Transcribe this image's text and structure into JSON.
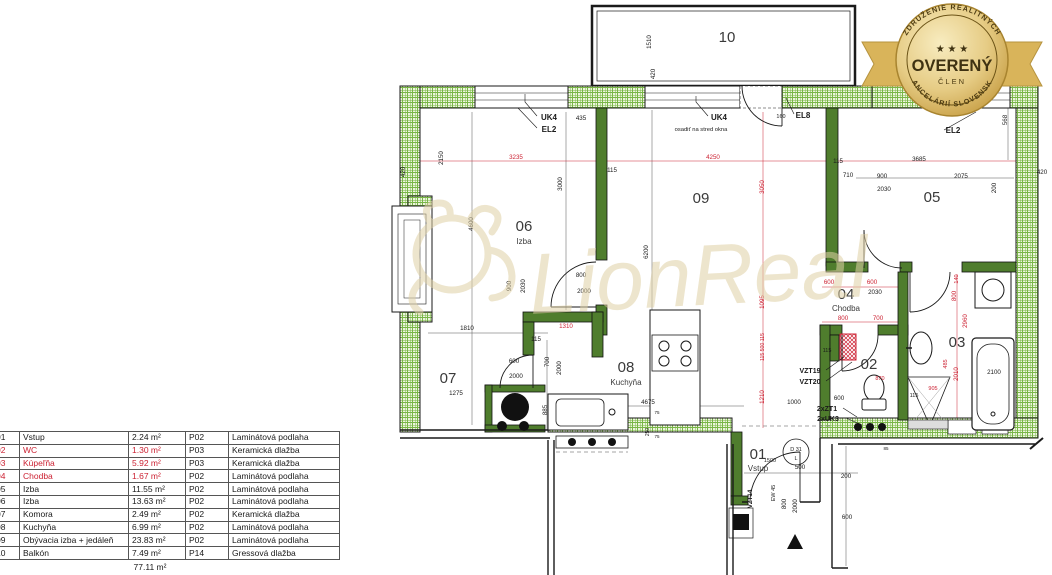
{
  "colors": {
    "dim_black": "#1a1a1a",
    "dim_red": "#cc2233",
    "wall_green": "#4f7d2d",
    "hatch_green": "#79b647",
    "badge_gold": "#d9b45a",
    "watermark_beige": "#e0d1a6"
  },
  "badge": {
    "arc_top": "ZDRUŽENIE REALITNÝCH",
    "arc_bottom": "KANCELÁRIÍ SLOVENSKA",
    "stars": "★ ★ ★",
    "title": "OVERENÝ",
    "subtitle": "ČLEN"
  },
  "watermark": {
    "text": "LionReal"
  },
  "legend_table": {
    "rows": [
      {
        "num": "01",
        "name": "Vstup",
        "area": "2.24 m²",
        "code": "P02",
        "floor": "Laminátová podlaha",
        "red": false
      },
      {
        "num": "02",
        "name": "WC",
        "area": "1.30 m²",
        "code": "P03",
        "floor": "Keramická dlažba",
        "red": true
      },
      {
        "num": "03",
        "name": "Kúpeľňa",
        "area": "5.92 m²",
        "code": "P03",
        "floor": "Keramická dlažba",
        "red": true
      },
      {
        "num": "04",
        "name": "Chodba",
        "area": "1.67 m²",
        "code": "P02",
        "floor": "Laminátová podlaha",
        "red": true
      },
      {
        "num": "05",
        "name": "Izba",
        "area": "11.55 m²",
        "code": "P02",
        "floor": "Laminátová podlaha",
        "red": false
      },
      {
        "num": "06",
        "name": "Izba",
        "area": "13.63 m²",
        "code": "P02",
        "floor": "Laminátová podlaha",
        "red": false
      },
      {
        "num": "07",
        "name": "Komora",
        "area": "2.49 m²",
        "code": "P02",
        "floor": "Keramická dlažba",
        "red": false
      },
      {
        "num": "08",
        "name": "Kuchyňa",
        "area": "6.99 m²",
        "code": "P02",
        "floor": "Laminátová podlaha",
        "red": false
      },
      {
        "num": "09",
        "name": "Obývacia izba + jedáleň",
        "area": "23.83 m²",
        "code": "P02",
        "floor": "Laminátová podlaha",
        "red": false
      },
      {
        "num": "10",
        "name": "Balkón",
        "area": "7.49 m²",
        "code": "P14",
        "floor": "Gressová dlažba",
        "red": false
      }
    ],
    "total": "77.11 m²"
  },
  "floorplan": {
    "rooms": [
      {
        "num": "10",
        "x": 727,
        "y": 42
      },
      {
        "num": "06",
        "name": "Izba",
        "x": 524,
        "y": 231,
        "ny": 244
      },
      {
        "num": "09",
        "x": 701,
        "y": 203
      },
      {
        "num": "05",
        "x": 932,
        "y": 202
      },
      {
        "num": "07",
        "x": 448,
        "y": 383
      },
      {
        "num": "08",
        "name": "Kuchyňa",
        "x": 626,
        "y": 372,
        "ny": 385
      },
      {
        "num": "04",
        "name": "Chodba",
        "x": 846,
        "y": 299,
        "ny": 311
      },
      {
        "num": "02",
        "x": 869,
        "y": 369
      },
      {
        "num": "03",
        "x": 957,
        "y": 347
      },
      {
        "num": "01",
        "name": "Vstup",
        "x": 758,
        "y": 459,
        "ny": 471
      }
    ],
    "texts": [
      {
        "t": "1510",
        "x": 651,
        "y": 42,
        "v": 1
      },
      {
        "t": "420",
        "x": 655,
        "y": 74,
        "v": 1
      },
      {
        "t": "420",
        "x": 405,
        "y": 172,
        "v": 1
      },
      {
        "t": "2150",
        "x": 443,
        "y": 158,
        "v": 1
      },
      {
        "t": "4600",
        "x": 473,
        "y": 224,
        "v": 1
      },
      {
        "t": "3000",
        "x": 562,
        "y": 184,
        "v": 1
      },
      {
        "t": "6200",
        "x": 648,
        "y": 252,
        "v": 1
      },
      {
        "t": "435",
        "x": 581,
        "y": 120
      },
      {
        "t": "115",
        "x": 612,
        "y": 172
      },
      {
        "t": "115",
        "x": 838,
        "y": 163
      },
      {
        "t": "710",
        "x": 848,
        "y": 177
      },
      {
        "t": "900",
        "x": 882,
        "y": 178
      },
      {
        "t": "2030",
        "x": 884,
        "y": 191
      },
      {
        "t": "2075",
        "x": 961,
        "y": 178
      },
      {
        "t": "3685",
        "x": 919,
        "y": 161
      },
      {
        "t": "200",
        "x": 996,
        "y": 188,
        "v": 1
      },
      {
        "t": "568",
        "x": 1007,
        "y": 120,
        "v": 1
      },
      {
        "t": "420",
        "x": 1042,
        "y": 174
      },
      {
        "t": "900",
        "x": 511,
        "y": 286,
        "v": 1
      },
      {
        "t": "2030",
        "x": 525,
        "y": 286,
        "v": 1
      },
      {
        "t": "800",
        "x": 581,
        "y": 277
      },
      {
        "t": "2000",
        "x": 584,
        "y": 293
      },
      {
        "t": "1810",
        "x": 467,
        "y": 330
      },
      {
        "t": "1275",
        "x": 456,
        "y": 395
      },
      {
        "t": "115",
        "x": 536,
        "y": 341
      },
      {
        "t": "700",
        "x": 549,
        "y": 362,
        "v": 1
      },
      {
        "t": "2000",
        "x": 561,
        "y": 368,
        "v": 1
      },
      {
        "t": "600",
        "x": 514,
        "y": 363
      },
      {
        "t": "2000",
        "x": 516,
        "y": 378
      },
      {
        "t": "885",
        "x": 547,
        "y": 410,
        "v": 1
      },
      {
        "t": "4675",
        "x": 648,
        "y": 404
      },
      {
        "t": "1000",
        "x": 794,
        "y": 404
      },
      {
        "t": "600",
        "x": 839,
        "y": 400
      },
      {
        "t": "250",
        "x": 649,
        "y": 432,
        "v": 1,
        "s": 5
      },
      {
        "t": "75",
        "x": 657,
        "y": 414,
        "s": 4.5
      },
      {
        "t": "75",
        "x": 657,
        "y": 438,
        "s": 4.5
      },
      {
        "t": "85",
        "x": 886,
        "y": 450,
        "s": 4.5
      },
      {
        "t": "115",
        "x": 914,
        "y": 397,
        "s": 5.5
      },
      {
        "t": "1500",
        "x": 770,
        "y": 462,
        "s": 5.5
      },
      {
        "t": "500",
        "x": 800,
        "y": 469
      },
      {
        "t": "200",
        "x": 846,
        "y": 478
      },
      {
        "t": "600",
        "x": 847,
        "y": 519
      },
      {
        "t": "800",
        "x": 786,
        "y": 504,
        "v": 1
      },
      {
        "t": "2000",
        "x": 797,
        "y": 506,
        "v": 1
      },
      {
        "t": "EW 45",
        "x": 775,
        "y": 493,
        "v": 1,
        "s": 5.5
      },
      {
        "t": "VZT14",
        "x": 752,
        "y": 499,
        "v": 1,
        "b": 1
      },
      {
        "t": "160",
        "x": 781,
        "y": 118,
        "s": 5.5
      },
      {
        "t": "2100",
        "x": 994,
        "y": 374
      },
      {
        "t": "3235",
        "x": 516,
        "y": 159,
        "c": "r"
      },
      {
        "t": "4250",
        "x": 713,
        "y": 159,
        "c": "r"
      },
      {
        "t": "3050",
        "x": 764,
        "y": 187,
        "v": 1,
        "c": "r"
      },
      {
        "t": "1095",
        "x": 764,
        "y": 302,
        "v": 1,
        "c": "r"
      },
      {
        "t": "115 500 115",
        "x": 764,
        "y": 347,
        "v": 1,
        "c": "r",
        "s": 5.2
      },
      {
        "t": "1210",
        "x": 764,
        "y": 397,
        "v": 1,
        "c": "r"
      },
      {
        "t": "1310",
        "x": 566,
        "y": 328,
        "c": "r"
      },
      {
        "t": "600",
        "x": 829,
        "y": 284,
        "c": "r"
      },
      {
        "t": "600",
        "x": 872,
        "y": 284,
        "c": "r"
      },
      {
        "t": "2030",
        "x": 875,
        "y": 294
      },
      {
        "t": "800",
        "x": 843,
        "y": 320,
        "c": "r"
      },
      {
        "t": "700",
        "x": 878,
        "y": 320,
        "c": "r"
      },
      {
        "t": "115",
        "x": 827,
        "y": 352,
        "s": 5.5
      },
      {
        "t": "870",
        "x": 880,
        "y": 380,
        "c": "r",
        "s": 5.5
      },
      {
        "t": "905",
        "x": 933,
        "y": 390,
        "c": "r",
        "s": 5.5
      },
      {
        "t": "140",
        "x": 958,
        "y": 279,
        "v": 1,
        "c": "r",
        "s": 5.5
      },
      {
        "t": "800",
        "x": 956,
        "y": 296,
        "v": 1,
        "c": "r"
      },
      {
        "t": "2960",
        "x": 967,
        "y": 321,
        "v": 1,
        "c": "r"
      },
      {
        "t": "485",
        "x": 947,
        "y": 364,
        "v": 1,
        "c": "r",
        "s": 5.5
      },
      {
        "t": "2010",
        "x": 958,
        "y": 374,
        "v": 1,
        "c": "r"
      },
      {
        "t": "VZT19",
        "x": 810,
        "y": 373,
        "b": 1,
        "s": 7
      },
      {
        "t": "VZT20",
        "x": 810,
        "y": 384,
        "b": 1,
        "s": 7
      },
      {
        "t": "2xZT1",
        "x": 827,
        "y": 411,
        "b": 1,
        "s": 7
      },
      {
        "t": "2xUK3",
        "x": 828,
        "y": 421,
        "b": 1,
        "s": 7
      },
      {
        "t": "UK4",
        "x": 549,
        "y": 120,
        "b": 1,
        "s": 8
      },
      {
        "t": "EL2",
        "x": 549,
        "y": 132,
        "b": 1,
        "s": 8
      },
      {
        "t": "UK4",
        "x": 719,
        "y": 120,
        "b": 1,
        "s": 8
      },
      {
        "t": "osadiť na stred okna",
        "x": 701,
        "y": 131,
        "s": 5.8
      },
      {
        "t": "EL8",
        "x": 803,
        "y": 118,
        "b": 1,
        "s": 8
      },
      {
        "t": "EL2",
        "x": 953,
        "y": 133,
        "b": 1,
        "s": 8
      },
      {
        "t": "D 31",
        "x": 796,
        "y": 451,
        "s": 5.5
      },
      {
        "t": "L",
        "x": 796,
        "y": 460,
        "s": 5.5
      }
    ]
  }
}
